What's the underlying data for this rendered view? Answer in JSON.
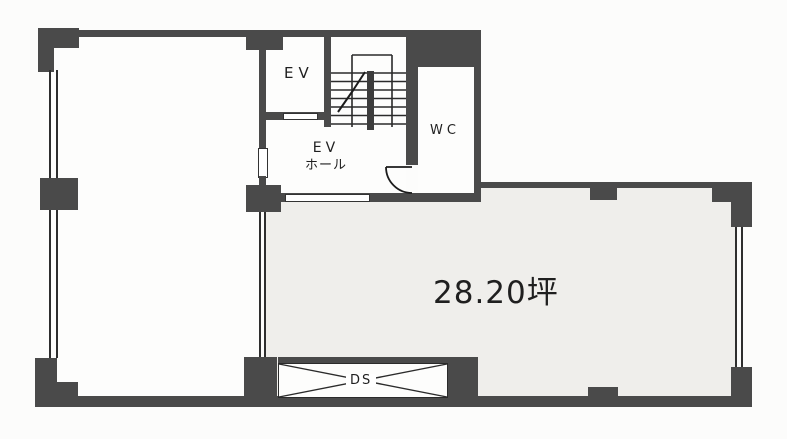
{
  "plan": {
    "title": "floor-plan",
    "rooms": {
      "elevator": {
        "label": "EV"
      },
      "elevator_hall": {
        "label_line1": "EV",
        "label_line2": "ホール"
      },
      "wc": {
        "label": "WC"
      },
      "duct_space": {
        "label": "DS"
      },
      "main_room": {
        "area_label": "28.20坪"
      }
    },
    "colors": {
      "wall": "#4a4a4a",
      "thin_line": "#2e2e2e",
      "main_room_fill": "#efeeeb",
      "room_fill": "#fdfdfc",
      "background": "#fcfcfb",
      "text": "#1f1f1f"
    }
  }
}
